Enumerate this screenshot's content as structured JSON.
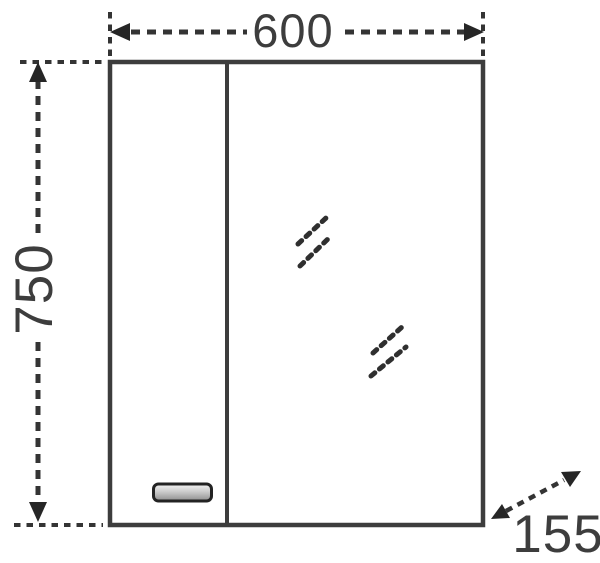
{
  "diagram": {
    "kind": "technical-dimension-drawing",
    "dimensions": {
      "width": "600",
      "height": "750",
      "depth": "155"
    },
    "colors": {
      "background": "#ffffff",
      "line": "#3d3d3d",
      "dash": "#343434",
      "arrow": "#262626",
      "text": "#3d3d3d",
      "handle_border": "#232323",
      "handle_fill_top": "#f4f4f4",
      "handle_fill_mid": "#cccccc",
      "handle_fill_bottom": "#8d8d8d"
    },
    "icons": [
      "left-arrowhead-icon",
      "right-arrowhead-icon",
      "up-arrowhead-icon",
      "down-arrowhead-icon",
      "diagonal-arrowhead-icon",
      "mirror-shine-icon"
    ]
  }
}
